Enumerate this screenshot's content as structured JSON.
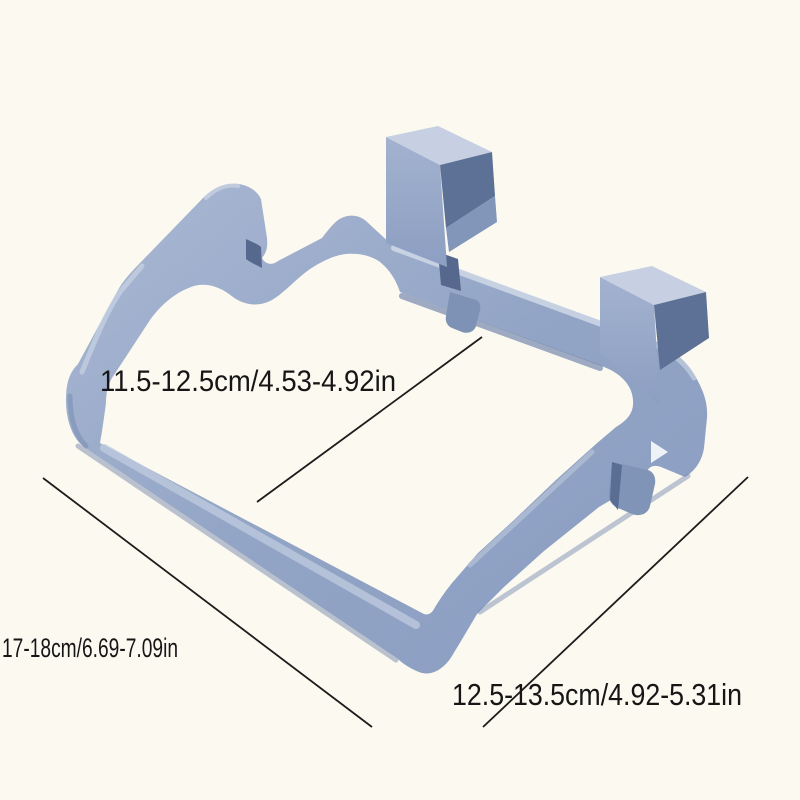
{
  "image": {
    "kind": "product-dimension-diagram",
    "subject": "over-cabinet-door hanging trash bag holder frame with two square hooks",
    "background": "#fcf9f0"
  },
  "palette": {
    "plastic_mid": "#93a5c6",
    "plastic_light": "#aebcd6",
    "plastic_band": "#d3dbe8",
    "plastic_dark": "#7488ac",
    "plastic_shadow": "#5d7095",
    "slot_dark": "#56688e",
    "highlight_triangle": "#eef1f6",
    "line": "#1c1c1c",
    "text": "#161616"
  },
  "annotations": {
    "inner_width": {
      "label": "11.5-12.5cm/4.53-4.92in"
    },
    "side_depth": {
      "label": "17-18cm/6.69-7.09in"
    },
    "bottom_width": {
      "label": "12.5-13.5cm/4.92-5.31in"
    }
  }
}
